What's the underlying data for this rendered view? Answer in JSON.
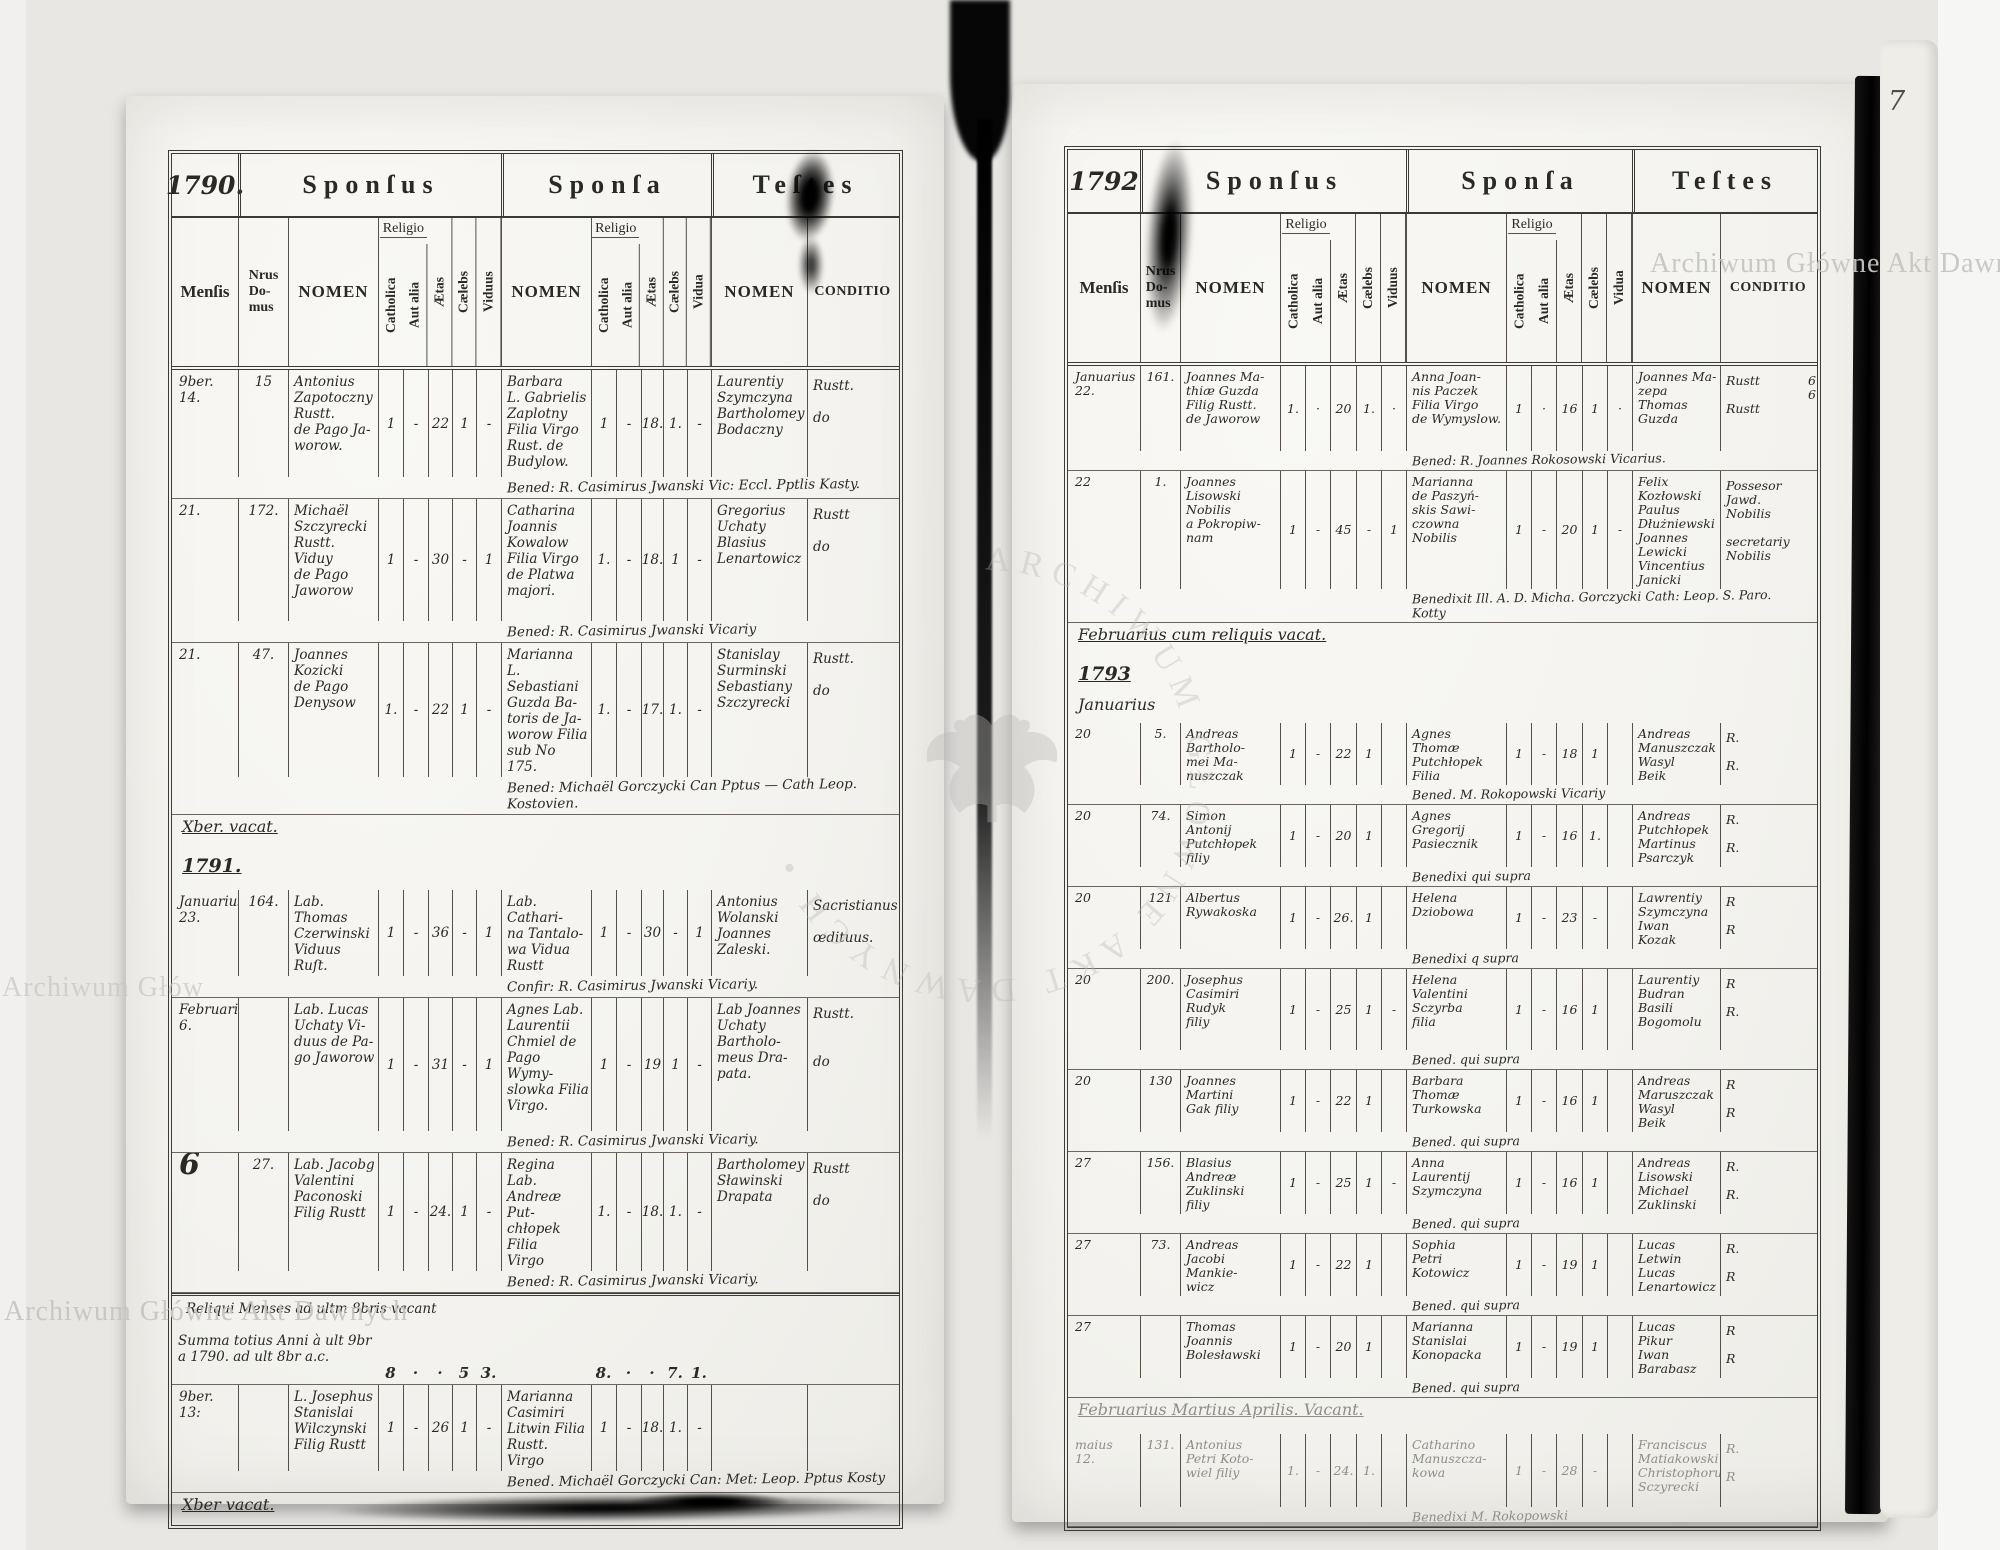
{
  "meta": {
    "page_number": "7",
    "watermark": {
      "full": "Archiwum Główne Akt Dawnych",
      "partial_left": "Archiwum Głów",
      "ring": "ARCHIWUM GŁÓWNE AKT DAWNYCH"
    }
  },
  "labels": {
    "sponsus": "Sponſus",
    "sponsa": "Sponſa",
    "testes": "Teſtes"
  },
  "columns": {
    "mensis": "Menſis",
    "nrus": "Nrus\nDo-\nmus",
    "nomen": "NOMEN",
    "religio": "Religio",
    "catholica": "Catholica",
    "aut_alia": "Aut alia",
    "aetas": "Ætas",
    "caelebs": "Cælebs",
    "viduus": "Viduus",
    "vidua": "Vidua",
    "conditio": "CONDITIO"
  },
  "left_page": {
    "year": "1790.",
    "items": [
      {
        "type": "row",
        "h": 128,
        "m": "9ber.\n14.",
        "n": "15",
        "g": "Antonius\nZapotoczny\nRustt.\nde Pago Ja-\nworow.",
        "gs": [
          "1",
          "-",
          "22",
          "1",
          "-"
        ],
        "b": "Barbara\nL. Gabrielis\nZaplotny\nFilia Virgo\nRust. de\nBudylow.",
        "bs": [
          "1",
          "-",
          "18.",
          "1.",
          "-"
        ],
        "t": "Laurentiy\nSzymczyna\nBartholomey\nBodaczny",
        "c": "Rustt.\n\ndo",
        "note": "Bened: R. Casimirus Jwanski Vic: Eccl. Pptlis Kasty."
      },
      {
        "type": "row",
        "h": 143,
        "m": "21.",
        "n": "172.",
        "g": "Michaël\nSzczyrecki\nRustt. Viduy\nde Pago\nJaworow",
        "gs": [
          "1",
          "-",
          "30",
          "-",
          "1"
        ],
        "b": "Catharina\nJoannis\nKowalow\nFilia Virgo\nde Platwa\nmajori.",
        "bs": [
          "1.",
          "-",
          "18.",
          "1",
          "-"
        ],
        "t": "Gregorius\nUchaty\nBlasius\nLenartowicz",
        "c": "Rustt\n\ndo",
        "note": "Bened: R. Casimirus Jwanski Vicariy"
      },
      {
        "type": "row",
        "h": 155,
        "m": "21.",
        "n": "47.",
        "g": "Joannes\nKozicki\nde Pago\nDenysow",
        "gs": [
          "1.",
          "-",
          "22",
          "1",
          "-"
        ],
        "b": "Marianna\nL. Sebastiani\nGuzda Ba-\ntoris de Ja-\nworow Filia\nsub No 175.",
        "bs": [
          "1.",
          "-",
          "17.",
          "1.",
          "-"
        ],
        "t": "Stanislay\nSurminski\nSebastiany\nSzczyrecki",
        "c": "Rustt.\n\ndo",
        "note": "Bened: Michaël Gorczycki Can Pptus — Cath Leop. Kostovien."
      },
      {
        "type": "note",
        "h": 33,
        "cls": "vacat",
        "text": "Xber. vacat."
      },
      {
        "type": "note",
        "h": 30,
        "cls": "year",
        "text": "1791."
      },
      {
        "type": "row",
        "h": 98,
        "m": "Januarius.\n23.",
        "n": "164.",
        "g": "Lab. Thomas\nCzerwinski\nViduus Ruſt.",
        "gs": [
          "1",
          "-",
          "36",
          "-",
          "1"
        ],
        "b": "Lab. Cathari-\nna Tantalo-\nwa Vidua\nRustt",
        "bs": [
          "1",
          "-",
          "30",
          "-",
          "1"
        ],
        "t": "Antonius\nWolanski\nJoannes\nZaleski.",
        "c": "Sacristianus\n\nœdituus.",
        "note": "Confir: R. Casimirus Jwanski Vicariy."
      },
      {
        "type": "row",
        "h": 154,
        "m": "Februarius.\n6.",
        "n": "",
        "g": "Lab. Lucas\nUchaty Vi-\nduus de Pa-\ngo Jaworow",
        "gs": [
          "1",
          "-",
          "31",
          "-",
          "1"
        ],
        "b": "Agnes Lab.\nLaurentii\nChmiel de\nPago Wymy-\nslowka Filia\nVirgo.",
        "bs": [
          "1",
          "-",
          "19",
          "1",
          "-"
        ],
        "t": "Lab Joannes\nUchaty\nBartholo-\nmeus Dra-\npata.",
        "c": "Rustt.\n\n\ndo",
        "note": "Bened: R. Casimirus Jwanski Vicariy."
      },
      {
        "type": "row",
        "h": 130,
        "big": true,
        "m": "6",
        "n": "27.",
        "g": "Lab. Jacobg\nValentini\nPaconoski\nFilig Rustt",
        "gs": [
          "1",
          "-",
          "24.",
          "1",
          "-"
        ],
        "b": "Regina Lab.\nAndreæ Put-\nchłopek Filia\nVirgo",
        "bs": [
          "1.",
          "-",
          "18.",
          "1.",
          "-"
        ],
        "t": "Bartholomey\nSławinski\nDrapata",
        "c": "Rustt\n\ndo",
        "note": "Bened: R. Casimirus Jwanski Vicariy."
      },
      {
        "type": "summary",
        "h": 86,
        "l1": "Reliqui Menses ad ultm 8bris vacant",
        "l23": "Summa totius Anni à ult 9br\na 1790. ad ult 8br a.c.",
        "gs": [
          "8",
          "·",
          "·",
          "5",
          "3."
        ],
        "bs": [
          "8.",
          "·",
          "·",
          "7.",
          "1."
        ]
      },
      {
        "type": "row",
        "h": 94,
        "m": "9ber.\n13:",
        "n": "",
        "g": "L. Josephus\nStanislai\nWilczynski\nFilig Rustt",
        "gs": [
          "1",
          "-",
          "26",
          "1",
          "-"
        ],
        "b": "Marianna\nCasimiri\nLitwin Filia\nRustt. Virgo",
        "bs": [
          "1",
          "-",
          "18.",
          "1.",
          "-"
        ],
        "t": "",
        "c": "",
        "note": "Bened. Michaël Gorczycki Can: Met: Leop. Pptus Kosty"
      },
      {
        "type": "note",
        "h": 26,
        "cls": "vacat",
        "text": "Xber vacat."
      }
    ]
  },
  "right_page": {
    "year": "1792",
    "items": [
      {
        "type": "row",
        "h": 104,
        "m": "Januarius\n22.",
        "n": "161.",
        "g": "Joannes Ma-\nthiæ Guzda\nFilig Rustt.\nde Jaworow",
        "gs": [
          "1.",
          "·",
          "20",
          "1.",
          "·"
        ],
        "b": "Anna Joan-\nnis Paczek\nFilia Virgo\nde Wymyslow.",
        "bs": [
          "1",
          "·",
          "16",
          "1",
          "·"
        ],
        "t": "Joannes Ma-\nzepa\nThomas\nGuzda",
        "c": "Rustt\n\nRustt",
        "marks": "6\n6",
        "note": "Bened: R. Joannes Rokosowski Vicarius."
      },
      {
        "type": "row",
        "h": 142,
        "m": "22",
        "n": "1.",
        "g": "Joannes\nLisowski\nNobilis\na Pokropiw-\nnam",
        "gs": [
          "1",
          "-",
          "45",
          "-",
          "1"
        ],
        "b": "Marianna\nde Paszyń-\nskis Sawi-\nczowna\nNobilis",
        "bs": [
          "1",
          "-",
          "20",
          "1",
          "-"
        ],
        "t": "Felix\nKozłowski\nPaulus\nDłużniewski\nJoannes\nLewicki\nVincentius\nJanicki",
        "c": "Possesor Jawd.\nNobilis\n\nsecretariy\nNobilis",
        "note": "Benedixit Ill. A. D. Micha. Gorczycki Cath: Leop. S. Paro. Kotty"
      },
      {
        "type": "note",
        "h": 34,
        "cls": "vacat",
        "text": "Februarius cum reliquis vacat."
      },
      {
        "type": "note",
        "h": 24,
        "cls": "year",
        "text": "1793"
      },
      {
        "type": "note",
        "h": 24,
        "cls": "month",
        "text": "Januarius"
      },
      {
        "type": "row",
        "h": 76,
        "m": "20",
        "n": "5.",
        "g": "Andreas\nBartholo-\nmei Ma-\nnuszczak",
        "gs": [
          "1",
          "-",
          "22",
          "1",
          ""
        ],
        "b": "Agnes\nThomæ\nPutchłopek\nFilia",
        "bs": [
          "1",
          "-",
          "18",
          "1",
          ""
        ],
        "t": "Andreas\nManuszczak\nWasyl\nBeik",
        "c": "R.\n\nR.",
        "note": "Bened. M. Rokopowski Vicariy"
      },
      {
        "type": "row",
        "h": 80,
        "m": "20",
        "n": "74.",
        "g": "Simon\nAntonij\nPutchłopek\nfiliy",
        "gs": [
          "1",
          "-",
          "20",
          "1",
          ""
        ],
        "b": "Agnes\nGregorij\nPasiecznik",
        "bs": [
          "1",
          "-",
          "16",
          "1.",
          ""
        ],
        "t": "Andreas\nPutchłopek\nMartinus\nPsarczyk",
        "c": "R.\n\nR.",
        "note": "Benedixi qui supra"
      },
      {
        "type": "row",
        "h": 64,
        "m": "20",
        "n": "121",
        "g": "Albertus\nRywakoska",
        "gs": [
          "1",
          "-",
          "26.",
          "1",
          ""
        ],
        "b": "Helena\nDziobowa",
        "bs": [
          "1",
          "-",
          "23",
          "-",
          ""
        ],
        "t": "Lawrentiy\nSzymczyna\nIwan\nKozak",
        "c": "R\n\nR",
        "note": "Benedixi q supra"
      },
      {
        "type": "row",
        "h": 100,
        "m": "20",
        "n": "200.",
        "g": "Josephus\nCasimiri\nRudyk\nfiliy",
        "gs": [
          "1",
          "-",
          "25",
          "1",
          "-"
        ],
        "b": "Helena\nValentini\nSczyrba\nfilia",
        "bs": [
          "1",
          "-",
          "16",
          "1",
          ""
        ],
        "t": "Laurentiy\nBudran\nBasili\nBogomolu",
        "c": "R\n\nR.",
        "note": "Bened. qui supra"
      },
      {
        "type": "row",
        "h": 80,
        "m": "20",
        "n": "130",
        "g": "Joannes\nMartini\nGak filiy",
        "gs": [
          "1",
          "-",
          "22",
          "1",
          ""
        ],
        "b": "Barbara\nThomæ\nTurkowska",
        "bs": [
          "1",
          "-",
          "16",
          "1",
          ""
        ],
        "t": "Andreas\nMaruszczak\nWasyl\nBeik",
        "c": "R\n\nR",
        "note": "Bened. qui supra"
      },
      {
        "type": "row",
        "h": 64,
        "m": "27",
        "n": "156.",
        "g": "Blasius\nAndreæ\nZuklinski\nfiliy",
        "gs": [
          "1",
          "-",
          "25",
          "1",
          "-"
        ],
        "b": "Anna\nLaurentij\nSzymczyna",
        "bs": [
          "1",
          "-",
          "16",
          "1",
          ""
        ],
        "t": "Andreas\nLisowski\nMichael\nZuklinski",
        "c": "R.\n\nR.",
        "note": "Bened. qui supra"
      },
      {
        "type": "row",
        "h": 79,
        "m": "27",
        "n": "73.",
        "g": "Andreas\nJacobi\nMankie-\nwicz",
        "gs": [
          "1",
          "-",
          "22",
          "1",
          ""
        ],
        "b": "Sophia\nPetri\nKotowicz",
        "bs": [
          "1",
          "-",
          "19",
          "1",
          ""
        ],
        "t": "Lucas\nLetwin\nLucas\nLenartowicz",
        "c": "R.\n\nR",
        "note": "Bened. qui supra"
      },
      {
        "type": "row",
        "h": 79,
        "m": "27",
        "n": "",
        "g": "Thomas\nJoannis\nBolesławski",
        "gs": [
          "1",
          "-",
          "20",
          "1",
          ""
        ],
        "b": "Marianna\nStanislai\nKonopacka",
        "bs": [
          "1",
          "-",
          "19",
          "1",
          ""
        ],
        "t": "Lucas\nPikur\nIwan\nBarabasz",
        "c": "R\n\nR",
        "note": "Bened. qui supra"
      },
      {
        "type": "note",
        "h": 30,
        "cls": "vacat",
        "faint": true,
        "text": "Februarius Martius Aprilis. Vacant."
      },
      {
        "type": "row",
        "h": 92,
        "faint": true,
        "m": "maius\n12.",
        "n": "131.",
        "g": "Antonius\nPetri Koto-\nwiel filiy",
        "gs": [
          "1.",
          "-",
          "24.",
          "1.",
          ""
        ],
        "b": "Catharino\nManuszcza-\nkowa",
        "bs": [
          "1",
          "-",
          "28",
          "-",
          ""
        ],
        "t": "Franciscus\nMatiakowski\nChristophorus\nSczyrecki",
        "c": "R.\n\nR",
        "note": "Benedixi M. Rokopowski"
      }
    ]
  }
}
